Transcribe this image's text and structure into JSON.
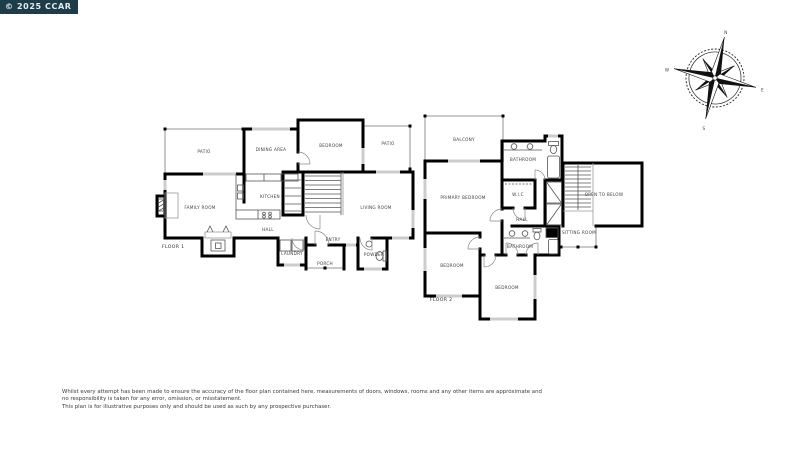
{
  "page": {
    "copyright": "© 2025 CCAR"
  },
  "compass": {
    "north": "N",
    "east": "E",
    "south": "S",
    "west": "W"
  },
  "floor1": {
    "name": "FLOOR 1",
    "rooms": {
      "patio_left": "PATIO",
      "dining": "DINING AREA",
      "bedroom": "BEDROOM",
      "patio_right": "PATIO",
      "family_room": "FAMILY ROOM",
      "kitchen": "KITCHEN",
      "living_room": "LIVING ROOM",
      "hall": "HALL",
      "entry": "ENTRY",
      "laundry": "LAUNDRY",
      "porch": "PORCH",
      "powder": "POWDER"
    }
  },
  "floor2": {
    "name": "FLOOR 2",
    "rooms": {
      "balcony": "BALCONY",
      "bathroom_top": "BATHROOM",
      "primary_bedroom": "PRIMARY BEDROOM",
      "wic": "W.I.C",
      "open_to_below": "OPEN TO BELOW",
      "hall": "HALL",
      "sitting_room": "SITTING ROOM",
      "bathroom_lower": "BATHROOM",
      "bedroom_left": "BEDROOM",
      "bedroom_bottom": "BEDROOM"
    }
  },
  "disclaimer": {
    "line1": "Whilst every attempt has been made to ensure the accuracy of the floor plan contained here, measurements of doors, windows, rooms and any other items are approximate and no responsibility is taken for any error, omission, or misstatement.",
    "line2": "This plan is for illustrative purposes only and should be used as such by any prospective purchaser."
  },
  "colors": {
    "wall": "#000000",
    "outdoor_wall": "#c2c2c2",
    "window": "#cccccc",
    "badge_bg": "#1e3d4a",
    "badge_text": "#e6ecee",
    "label_text": "#3d3d3d"
  }
}
